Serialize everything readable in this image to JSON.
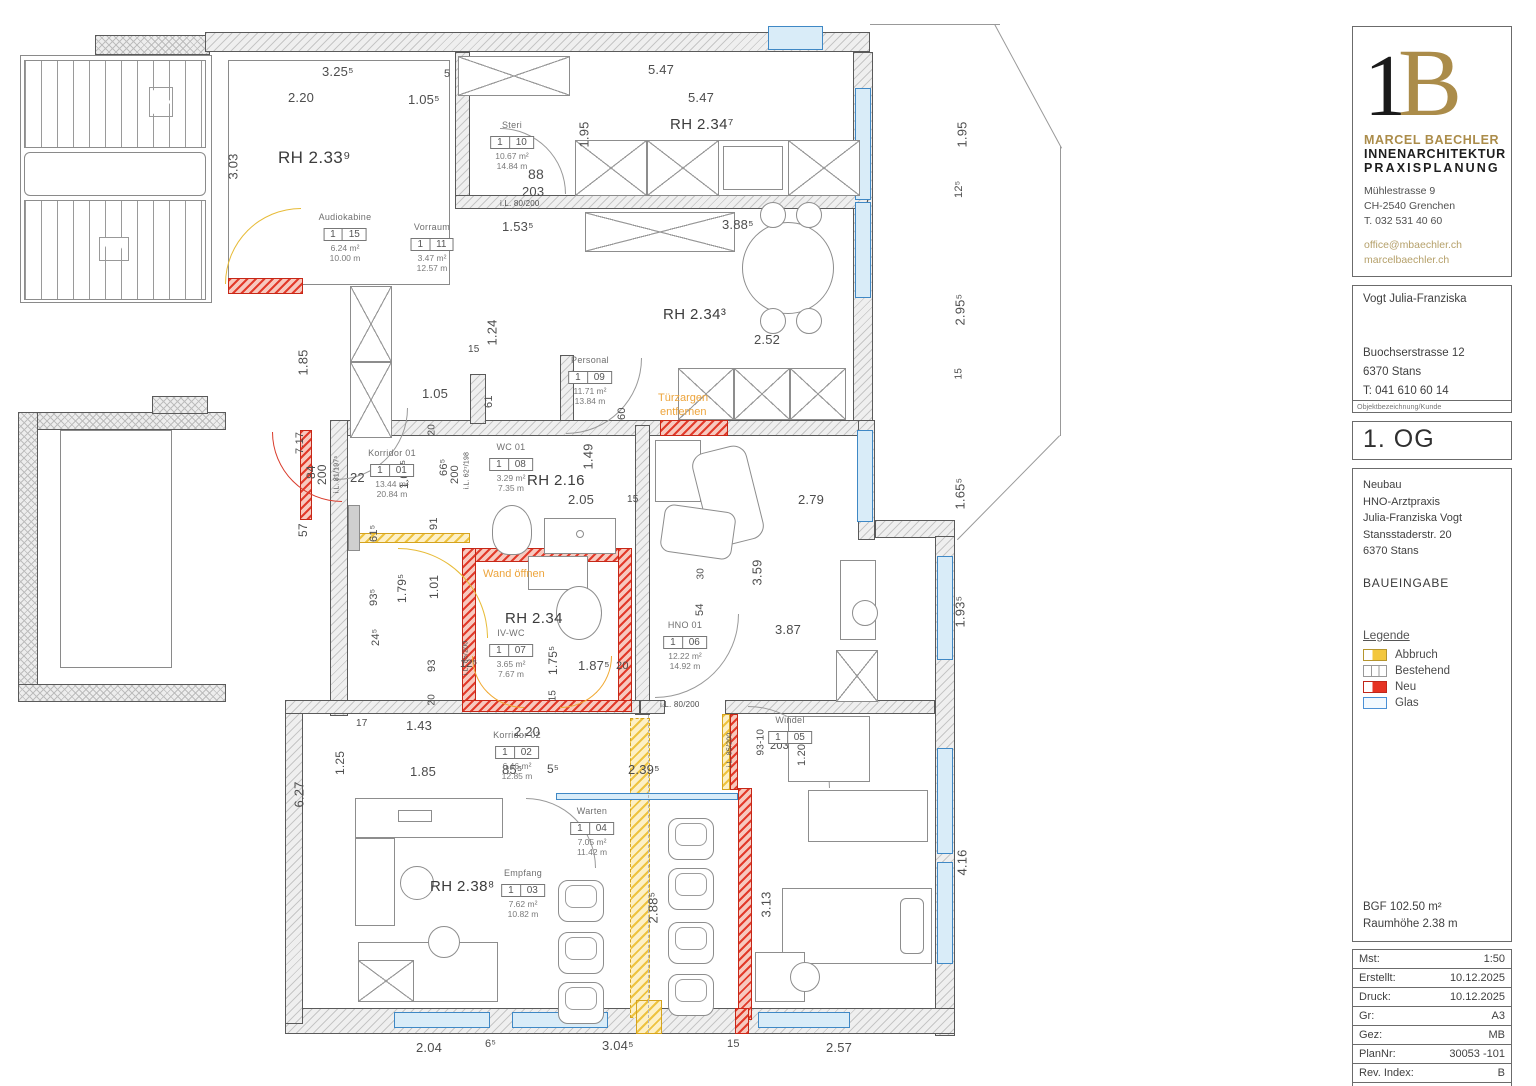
{
  "title_block": {
    "logo": {
      "mono1": "1",
      "mono2": "B",
      "name_line1": "MARCEL  BAECHLER",
      "name_line2": "INNENARCHITEKTUR",
      "name_line3": "PRAXISPLANUNG",
      "address": [
        "Mühlestrasse 9",
        "CH-2540 Grenchen",
        "T. 032 531 40 60"
      ],
      "links": [
        "office@mbaechler.ch",
        "marcelbaechler.ch"
      ]
    },
    "client": {
      "name": "Vogt Julia-Franziska",
      "street": "Buochserstrasse 12",
      "city": "6370 Stans",
      "phone": "T: 041 610 60 14",
      "caption": "Objektbezeichnung/Kunde"
    },
    "floor": "1. OG",
    "project": {
      "lines": [
        "Neubau",
        "HNO-Arztpraxis",
        "Julia-Franziska Vogt",
        "Stansstaderstr. 20",
        "6370 Stans"
      ],
      "stage": "BAUEINGABE"
    },
    "legend": {
      "title": "Legende",
      "items": [
        {
          "label": "Abbruch",
          "color": "#f3c73e",
          "style": "abbruch"
        },
        {
          "label": "Bestehend",
          "color": "#ffffff",
          "style": "bestehend"
        },
        {
          "label": "Neu",
          "color": "#e63323",
          "style": "neu"
        },
        {
          "label": "Glas",
          "color": "#4a90d5",
          "style": "glas"
        }
      ]
    },
    "stats": [
      "BGF 102.50 m²",
      "Raumhöhe 2.38 m"
    ],
    "meta": [
      {
        "label": "Mst:",
        "value": "1:50"
      },
      {
        "label": "Erstellt:",
        "value": "10.12.2025"
      },
      {
        "label": "Druck:",
        "value": "10.12.2025"
      },
      {
        "label": "Gr:",
        "value": "A3"
      },
      {
        "label": "Gez:",
        "value": "MB"
      },
      {
        "label": "PlanNr:",
        "value": "30053 -101"
      },
      {
        "label": "Rev. Index:",
        "value": "B"
      },
      {
        "label": "Seite:",
        "value": "1/1"
      }
    ]
  },
  "plan": {
    "rooms": [
      {
        "name": "Audiokabine",
        "no1": "1",
        "no2": "15",
        "area": "6.24 m²",
        "per": "10.00 m",
        "x": 345,
        "y": 212
      },
      {
        "name": "Vorraum",
        "no1": "1",
        "no2": "11",
        "area": "3.47 m²",
        "per": "12.57 m",
        "x": 432,
        "y": 222
      },
      {
        "name": "Steri",
        "no1": "1",
        "no2": "10",
        "area": "10.67 m²",
        "per": "14.84 m",
        "x": 512,
        "y": 120
      },
      {
        "name": "Personal",
        "no1": "1",
        "no2": "09",
        "area": "11.71 m²",
        "per": "13.84 m",
        "x": 590,
        "y": 355
      },
      {
        "name": "WC 01",
        "no1": "1",
        "no2": "08",
        "area": "3.29 m²",
        "per": "7.35 m",
        "x": 511,
        "y": 442
      },
      {
        "name": "IV-WC",
        "no1": "1",
        "no2": "07",
        "area": "3.65 m²",
        "per": "7.67 m",
        "x": 511,
        "y": 628
      },
      {
        "name": "HNO 01",
        "no1": "1",
        "no2": "06",
        "area": "12.22 m²",
        "per": "14.92 m",
        "x": 685,
        "y": 620
      },
      {
        "name": "Windel",
        "no1": "1",
        "no2": "05",
        "area": "",
        "per": "",
        "x": 790,
        "y": 715
      },
      {
        "name": "Warten",
        "no1": "1",
        "no2": "04",
        "area": "7.05 m²",
        "per": "11.42 m",
        "x": 592,
        "y": 806
      },
      {
        "name": "Empfang",
        "no1": "1",
        "no2": "03",
        "area": "7.62 m²",
        "per": "10.82 m",
        "x": 523,
        "y": 868
      },
      {
        "name": "Korridor 02",
        "no1": "1",
        "no2": "02",
        "area": "6.46 m²",
        "per": "12.85 m",
        "x": 517,
        "y": 730
      },
      {
        "name": "Korridor 01",
        "no1": "1",
        "no2": "01",
        "area": "13.44 m²",
        "per": "20.84 m",
        "x": 392,
        "y": 448
      }
    ],
    "rh_labels": [
      {
        "t": "RH 2.33⁹",
        "x": 278,
        "y": 148,
        "fs": 17
      },
      {
        "t": "RH 2.34⁷",
        "x": 670,
        "y": 116,
        "fs": 15
      },
      {
        "t": "RH 2.34³",
        "x": 663,
        "y": 306,
        "fs": 15
      },
      {
        "t": "RH 2.16",
        "x": 527,
        "y": 472,
        "fs": 15
      },
      {
        "t": "RH 2.34",
        "x": 505,
        "y": 610,
        "fs": 15
      },
      {
        "t": "RH 2.38⁸",
        "x": 430,
        "y": 878,
        "fs": 15
      }
    ],
    "notes": [
      {
        "t": "Türzargen",
        "x": 658,
        "y": 392
      },
      {
        "t": "entfernen",
        "x": 660,
        "y": 406
      },
      {
        "t": "Wand öffnen",
        "x": 483,
        "y": 568
      }
    ],
    "dimensions": [
      {
        "t": "3.25⁵",
        "x": 322,
        "y": 64
      },
      {
        "t": "2.20",
        "x": 288,
        "y": 90
      },
      {
        "t": "1.05⁵",
        "x": 408,
        "y": 92
      },
      {
        "t": "5",
        "x": 444,
        "y": 68,
        "fs": 11
      },
      {
        "t": "5.47",
        "x": 648,
        "y": 62
      },
      {
        "t": "5.47",
        "x": 688,
        "y": 90
      },
      {
        "t": "1.95",
        "x": 584,
        "y": 140,
        "v": 1
      },
      {
        "t": "1.95",
        "x": 962,
        "y": 140,
        "v": 1
      },
      {
        "t": "12⁵",
        "x": 959,
        "y": 192,
        "v": 1,
        "fs": 11
      },
      {
        "t": "2.95⁵",
        "x": 960,
        "y": 318,
        "v": 1
      },
      {
        "t": "15",
        "x": 959,
        "y": 374,
        "v": 1,
        "fs": 10
      },
      {
        "t": "1.65⁵",
        "x": 960,
        "y": 502,
        "v": 1
      },
      {
        "t": "1.93⁵",
        "x": 960,
        "y": 620,
        "v": 1
      },
      {
        "t": "4.16",
        "x": 962,
        "y": 868,
        "v": 1
      },
      {
        "t": "3.03",
        "x": 233,
        "y": 172,
        "v": 1
      },
      {
        "t": "1.85",
        "x": 303,
        "y": 368,
        "v": 1
      },
      {
        "t": "7.17",
        "x": 300,
        "y": 448,
        "v": 1,
        "fs": 11
      },
      {
        "t": "84",
        "x": 311,
        "y": 472,
        "v": 1,
        "fs": 12
      },
      {
        "t": "200",
        "x": 322,
        "y": 478,
        "v": 1,
        "fs": 12
      },
      {
        "t": "22",
        "x": 350,
        "y": 470,
        "fs": 13
      },
      {
        "t": "57",
        "x": 303,
        "y": 530,
        "v": 1,
        "fs": 12
      },
      {
        "t": "6.27",
        "x": 299,
        "y": 800,
        "v": 1
      },
      {
        "t": "1.53⁵",
        "x": 502,
        "y": 219
      },
      {
        "t": "3.88⁵",
        "x": 722,
        "y": 217
      },
      {
        "t": "88",
        "x": 528,
        "y": 166,
        "fs": 14
      },
      {
        "t": "203",
        "x": 522,
        "y": 184,
        "fs": 13
      },
      {
        "t": "i.L. 80/200",
        "x": 500,
        "y": 199,
        "fs": 8
      },
      {
        "t": "2.52",
        "x": 754,
        "y": 332
      },
      {
        "t": "60",
        "x": 622,
        "y": 414,
        "v": 1,
        "fs": 11
      },
      {
        "t": "1.24",
        "x": 492,
        "y": 338,
        "v": 1
      },
      {
        "t": "15",
        "x": 468,
        "y": 344,
        "fs": 10
      },
      {
        "t": "1.05",
        "x": 422,
        "y": 386
      },
      {
        "t": "61",
        "x": 489,
        "y": 402,
        "v": 1,
        "fs": 11
      },
      {
        "t": "20",
        "x": 432,
        "y": 430,
        "v": 1,
        "fs": 10
      },
      {
        "t": "66⁵",
        "x": 444,
        "y": 470,
        "v": 1,
        "fs": 11
      },
      {
        "t": "200",
        "x": 455,
        "y": 478,
        "v": 1,
        "fs": 11
      },
      {
        "t": "1.01⁵",
        "x": 404,
        "y": 482,
        "v": 1,
        "fs": 12
      },
      {
        "t": "91",
        "x": 434,
        "y": 524,
        "v": 1,
        "fs": 11
      },
      {
        "t": "61⁵",
        "x": 374,
        "y": 536,
        "v": 1,
        "fs": 11
      },
      {
        "t": "1.79⁵",
        "x": 402,
        "y": 596,
        "v": 1,
        "fs": 12
      },
      {
        "t": "1.01",
        "x": 434,
        "y": 592,
        "v": 1,
        "fs": 12
      },
      {
        "t": "93⁵",
        "x": 374,
        "y": 600,
        "v": 1,
        "fs": 11
      },
      {
        "t": "24⁵",
        "x": 376,
        "y": 640,
        "v": 1,
        "fs": 11
      },
      {
        "t": "93",
        "x": 432,
        "y": 666,
        "v": 1,
        "fs": 11
      },
      {
        "t": "20",
        "x": 432,
        "y": 700,
        "v": 1,
        "fs": 10
      },
      {
        "t": "i.L. 81/197⁵",
        "x": 337,
        "y": 490,
        "v": 1,
        "fs": 7
      },
      {
        "t": "i.L. 62⁷/198",
        "x": 467,
        "y": 486,
        "v": 1,
        "fs": 7
      },
      {
        "t": "1.49",
        "x": 588,
        "y": 462,
        "v": 1
      },
      {
        "t": "2.05",
        "x": 568,
        "y": 492
      },
      {
        "t": "15",
        "x": 627,
        "y": 494,
        "fs": 10
      },
      {
        "t": "2.79",
        "x": 798,
        "y": 492
      },
      {
        "t": "30",
        "x": 701,
        "y": 574,
        "v": 1,
        "fs": 10
      },
      {
        "t": "54",
        "x": 700,
        "y": 610,
        "v": 1,
        "fs": 11
      },
      {
        "t": "3.59",
        "x": 757,
        "y": 578,
        "v": 1
      },
      {
        "t": "3.87",
        "x": 775,
        "y": 622
      },
      {
        "t": "12⁵",
        "x": 460,
        "y": 658,
        "fs": 11
      },
      {
        "t": "1.75⁵",
        "x": 553,
        "y": 668,
        "v": 1,
        "fs": 12
      },
      {
        "t": "15",
        "x": 553,
        "y": 696,
        "v": 1,
        "fs": 10
      },
      {
        "t": "1.87⁵",
        "x": 578,
        "y": 658
      },
      {
        "t": "20",
        "x": 616,
        "y": 660,
        "fs": 11
      },
      {
        "t": "i.L. 85/200",
        "x": 466,
        "y": 672,
        "v": 1,
        "fs": 7
      },
      {
        "t": "i.L. 80/200",
        "x": 660,
        "y": 700,
        "fs": 8
      },
      {
        "t": "17",
        "x": 356,
        "y": 718,
        "fs": 10
      },
      {
        "t": "1.43",
        "x": 406,
        "y": 718
      },
      {
        "t": "2.20",
        "x": 514,
        "y": 724
      },
      {
        "t": "1.25",
        "x": 340,
        "y": 768,
        "v": 1,
        "fs": 12
      },
      {
        "t": "1.85",
        "x": 410,
        "y": 764
      },
      {
        "t": "85⁵",
        "x": 502,
        "y": 762,
        "fs": 13
      },
      {
        "t": "5⁵",
        "x": 547,
        "y": 762,
        "fs": 12
      },
      {
        "t": "2.39⁵",
        "x": 628,
        "y": 762
      },
      {
        "t": "93-10",
        "x": 761,
        "y": 750,
        "v": 1,
        "fs": 10
      },
      {
        "t": "203",
        "x": 770,
        "y": 740,
        "fs": 11
      },
      {
        "t": "1.20",
        "x": 802,
        "y": 760,
        "v": 1,
        "fs": 11
      },
      {
        "t": "i.L. 85/200",
        "x": 730,
        "y": 764,
        "v": 1,
        "fs": 7
      },
      {
        "t": "2.88⁵",
        "x": 653,
        "y": 916,
        "v": 1
      },
      {
        "t": "3.13",
        "x": 766,
        "y": 910,
        "v": 1
      },
      {
        "t": "2.04",
        "x": 416,
        "y": 1040
      },
      {
        "t": "6⁵",
        "x": 485,
        "y": 1038,
        "fs": 11
      },
      {
        "t": "3.04⁵",
        "x": 602,
        "y": 1038
      },
      {
        "t": "15",
        "x": 727,
        "y": 1038,
        "fs": 11
      },
      {
        "t": "2.57",
        "x": 826,
        "y": 1040
      }
    ]
  }
}
